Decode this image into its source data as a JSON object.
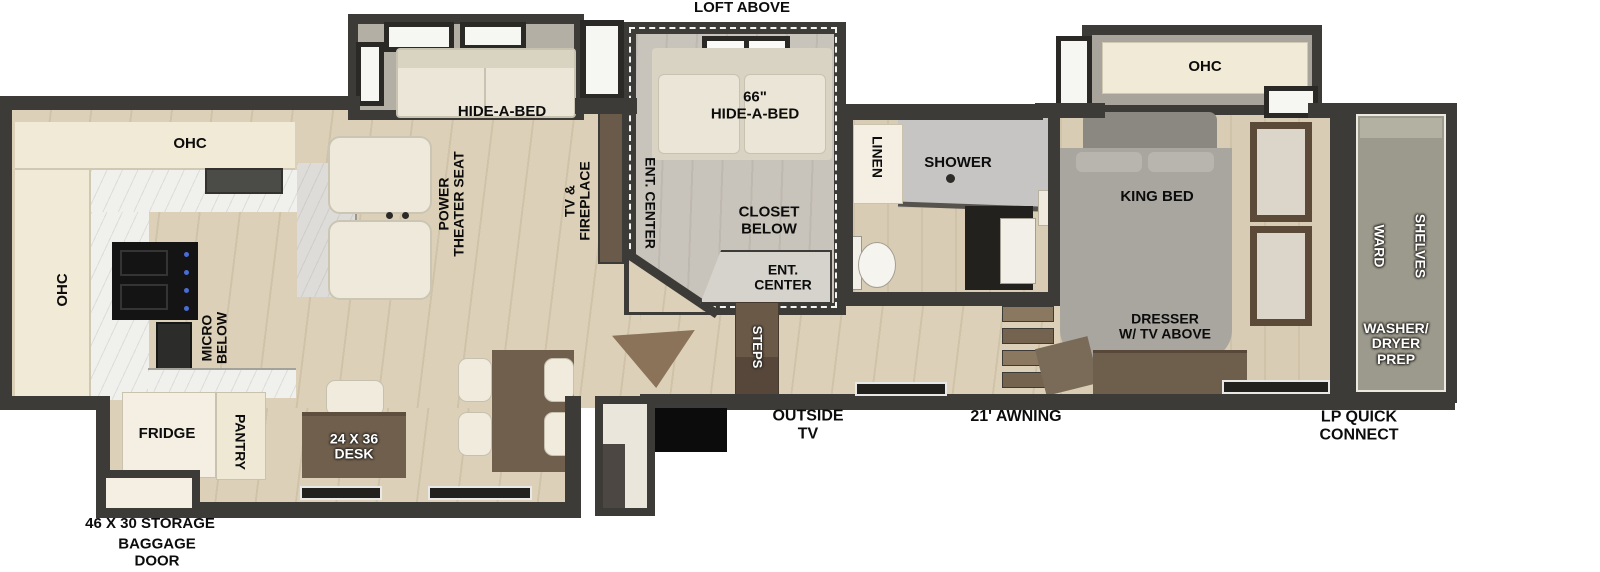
{
  "diagram_type": "RV fifth-wheel floor plan",
  "colors": {
    "wall": "#3d3b38",
    "floor_wood": "#dcd1b8",
    "cabinet_cream": "#f1ead7",
    "slide_floor_gray": "#b3afa5",
    "loft_floor_gray": "#c9c4bb",
    "marble_counter": "#f0f0ec",
    "furniture_brown": "#705f4d",
    "steps_brown": "#6b5948",
    "shower_gray": "#c6c5c3",
    "front_cap_olive": "#9c9a8c",
    "bed_gray": "#a9a6a0",
    "range_black": "#141414",
    "label_black": "#0c0c0c",
    "label_white": "#ffffff"
  },
  "labels": {
    "loft_above": "LOFT ABOVE",
    "slide_sofa": "HIDE-A-BED",
    "theater_seat": [
      "POWER",
      "THEATER SEAT"
    ],
    "tv_fireplace": [
      "TV &",
      "FIREPLACE"
    ],
    "ent_center_side": "ENT. CENTER",
    "loft_bed": [
      "66\"",
      "HIDE-A-BED"
    ],
    "closet_below": [
      "CLOSET",
      "BELOW"
    ],
    "ent_center_bottom": [
      "ENT.",
      "CENTER"
    ],
    "kitchen_ohc_top": "OHC",
    "kitchen_ohc_left": "OHC",
    "micro_below": [
      "MICRO",
      "BELOW"
    ],
    "fridge": "FRIDGE",
    "pantry": "PANTRY",
    "desk": [
      "24 X 36",
      "DESK"
    ],
    "storage": "46 X 30 STORAGE",
    "baggage_door": [
      "BAGGAGE",
      "DOOR"
    ],
    "linen": "LINEN",
    "shower": "SHOWER",
    "steps": "STEPS",
    "outside_tv": [
      "OUTSIDE",
      "TV"
    ],
    "awning": "21' AWNING",
    "bedroom_ohc": "OHC",
    "king_bed": "KING BED",
    "dresser": [
      "DRESSER",
      "W/ TV ABOVE"
    ],
    "ward": "WARD",
    "shelves": "SHELVES",
    "washer_dryer": [
      "WASHER/",
      "DRYER",
      "PREP"
    ],
    "lp_quick": [
      "LP QUICK",
      "CONNECT"
    ]
  }
}
